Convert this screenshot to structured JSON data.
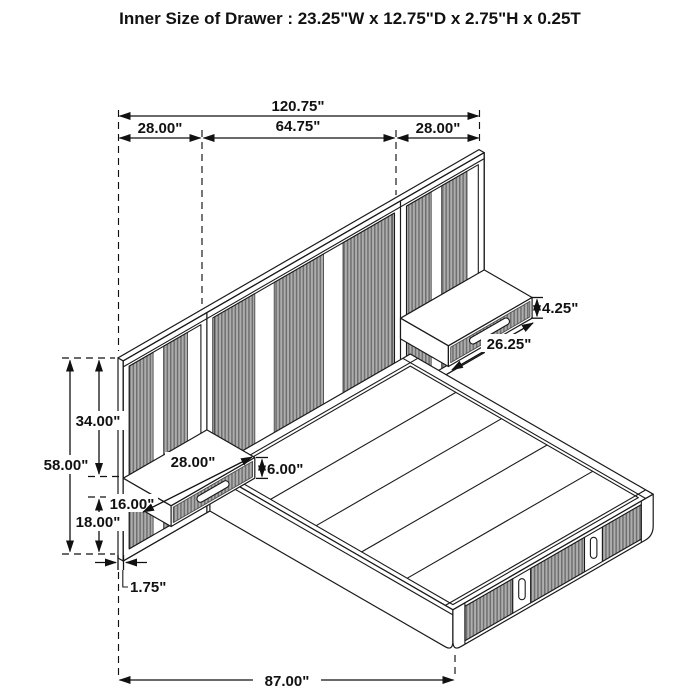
{
  "title": "Inner Size of Drawer : 23.25\"W x 12.75\"D x 2.75\"H x 0.25T",
  "dims": {
    "total_width": "120.75\"",
    "left_section_width": "28.00\"",
    "center_section_width": "64.75\"",
    "right_section_width": "28.00\"",
    "panel_height": "58.00\"",
    "top_to_nightstand": "34.00\"",
    "nightstand_floor_clearance": "18.00\"",
    "nightstand_depth": "16.00\"",
    "nightstand_width": "28.00\"",
    "nightstand_height": "6.00\"",
    "drawer_front_width": "26.25\"",
    "drawer_front_height": "4.25\"",
    "panel_thickness": "1.75\"",
    "bed_length": "87.00\""
  }
}
